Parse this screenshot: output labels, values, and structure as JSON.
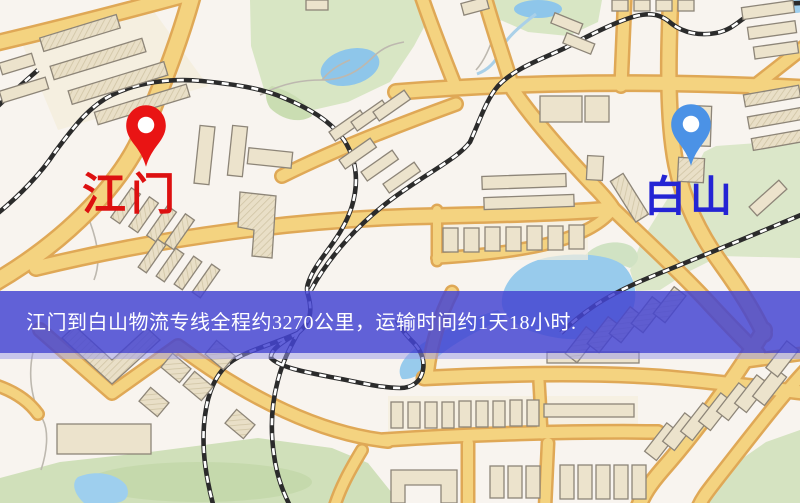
{
  "map": {
    "origin_marker": {
      "label": "江门",
      "pin_color": "#e91414",
      "label_color": "#dd1010"
    },
    "dest_marker": {
      "label": "白山",
      "pin_color": "#4b92e6",
      "label_color": "#2424d4"
    },
    "banner": {
      "text": "江门到白山物流专线全程约3270公里，运输时间约1天18小时.",
      "distance_km": "3270",
      "duration": "1天18小时",
      "background": "#4444d2",
      "text_color": "#ffffff"
    },
    "colors": {
      "road": "#f6d37c",
      "road_casing": "#e2a851",
      "water": "#8cc6ec",
      "park": "#d8e6c3",
      "building": "#ece3cb",
      "railway": "#2b2b2b",
      "background": "#f8f4ef"
    }
  }
}
